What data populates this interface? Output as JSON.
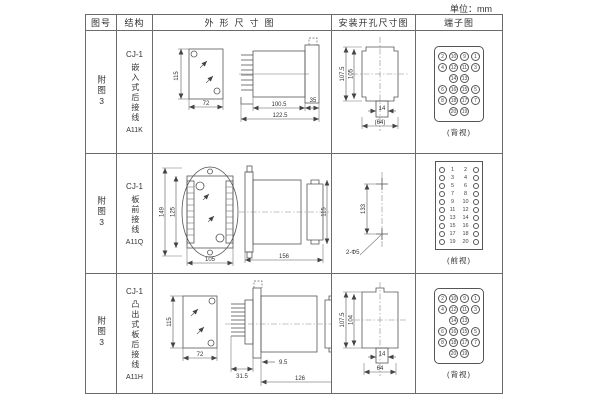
{
  "unit_label": "单位：mm",
  "headers": {
    "fig_no": "图号",
    "structure": "结构",
    "outline": "外形尺寸图",
    "install": "安装开孔尺寸图",
    "terminal": "端子图"
  },
  "rows": [
    {
      "fig_no": "附图3",
      "model": "CJ-1",
      "structure_vertical": "嵌入式后接线",
      "code": "A11K",
      "outline": {
        "front_h": "115",
        "front_w": "72",
        "side_d1": "100.5",
        "side_d2": "122.5",
        "side_d3": "35"
      },
      "install": {
        "v1": "107.5",
        "v2": "105",
        "w1": "14",
        "w2": "(64)"
      },
      "terminal": {
        "view_label": "(背视)",
        "grid": [
          [
            "2",
            "10",
            "9",
            "1"
          ],
          [
            "4",
            "12",
            "11",
            "3"
          ],
          [
            "",
            "14",
            "13",
            ""
          ],
          [
            "6",
            "16",
            "15",
            "5"
          ],
          [
            "8",
            "18",
            "17",
            "7"
          ],
          [
            "",
            "20",
            "19",
            ""
          ]
        ]
      }
    },
    {
      "fig_no": "附图3",
      "model": "CJ-1",
      "structure_vertical": "板前接线",
      "code": "A11Q",
      "outline": {
        "front_h1": "149",
        "front_h2": "125",
        "front_w": "105",
        "side_l": "156",
        "side_h": "115"
      },
      "install": {
        "v1": "133",
        "hole_label": "2-Φ5"
      },
      "terminal": {
        "view_label": "(前视)",
        "left_nums": [
          "1",
          "3",
          "5",
          "7",
          "9",
          "11",
          "13",
          "15",
          "17",
          "19"
        ],
        "right_nums": [
          "2",
          "4",
          "6",
          "8",
          "10",
          "12",
          "14",
          "16",
          "18",
          "20"
        ]
      }
    },
    {
      "fig_no": "附图3",
      "model": "CJ-1",
      "structure_vertical": "凸出式板后接线",
      "code": "A11H",
      "outline": {
        "front_h": "115",
        "front_w": "72",
        "side_d1": "31.5",
        "side_d2": "9.5",
        "side_d3": "126"
      },
      "install": {
        "v1": "107.5",
        "v2": "104",
        "w1": "14",
        "w2": "64"
      },
      "terminal": {
        "view_label": "(背视)",
        "grid": [
          [
            "2",
            "10",
            "9",
            "1"
          ],
          [
            "4",
            "12",
            "11",
            "3"
          ],
          [
            "",
            "14",
            "13",
            ""
          ],
          [
            "6",
            "16",
            "15",
            "5"
          ],
          [
            "8",
            "18",
            "17",
            "7"
          ],
          [
            "",
            "20",
            "19",
            ""
          ]
        ]
      }
    }
  ]
}
